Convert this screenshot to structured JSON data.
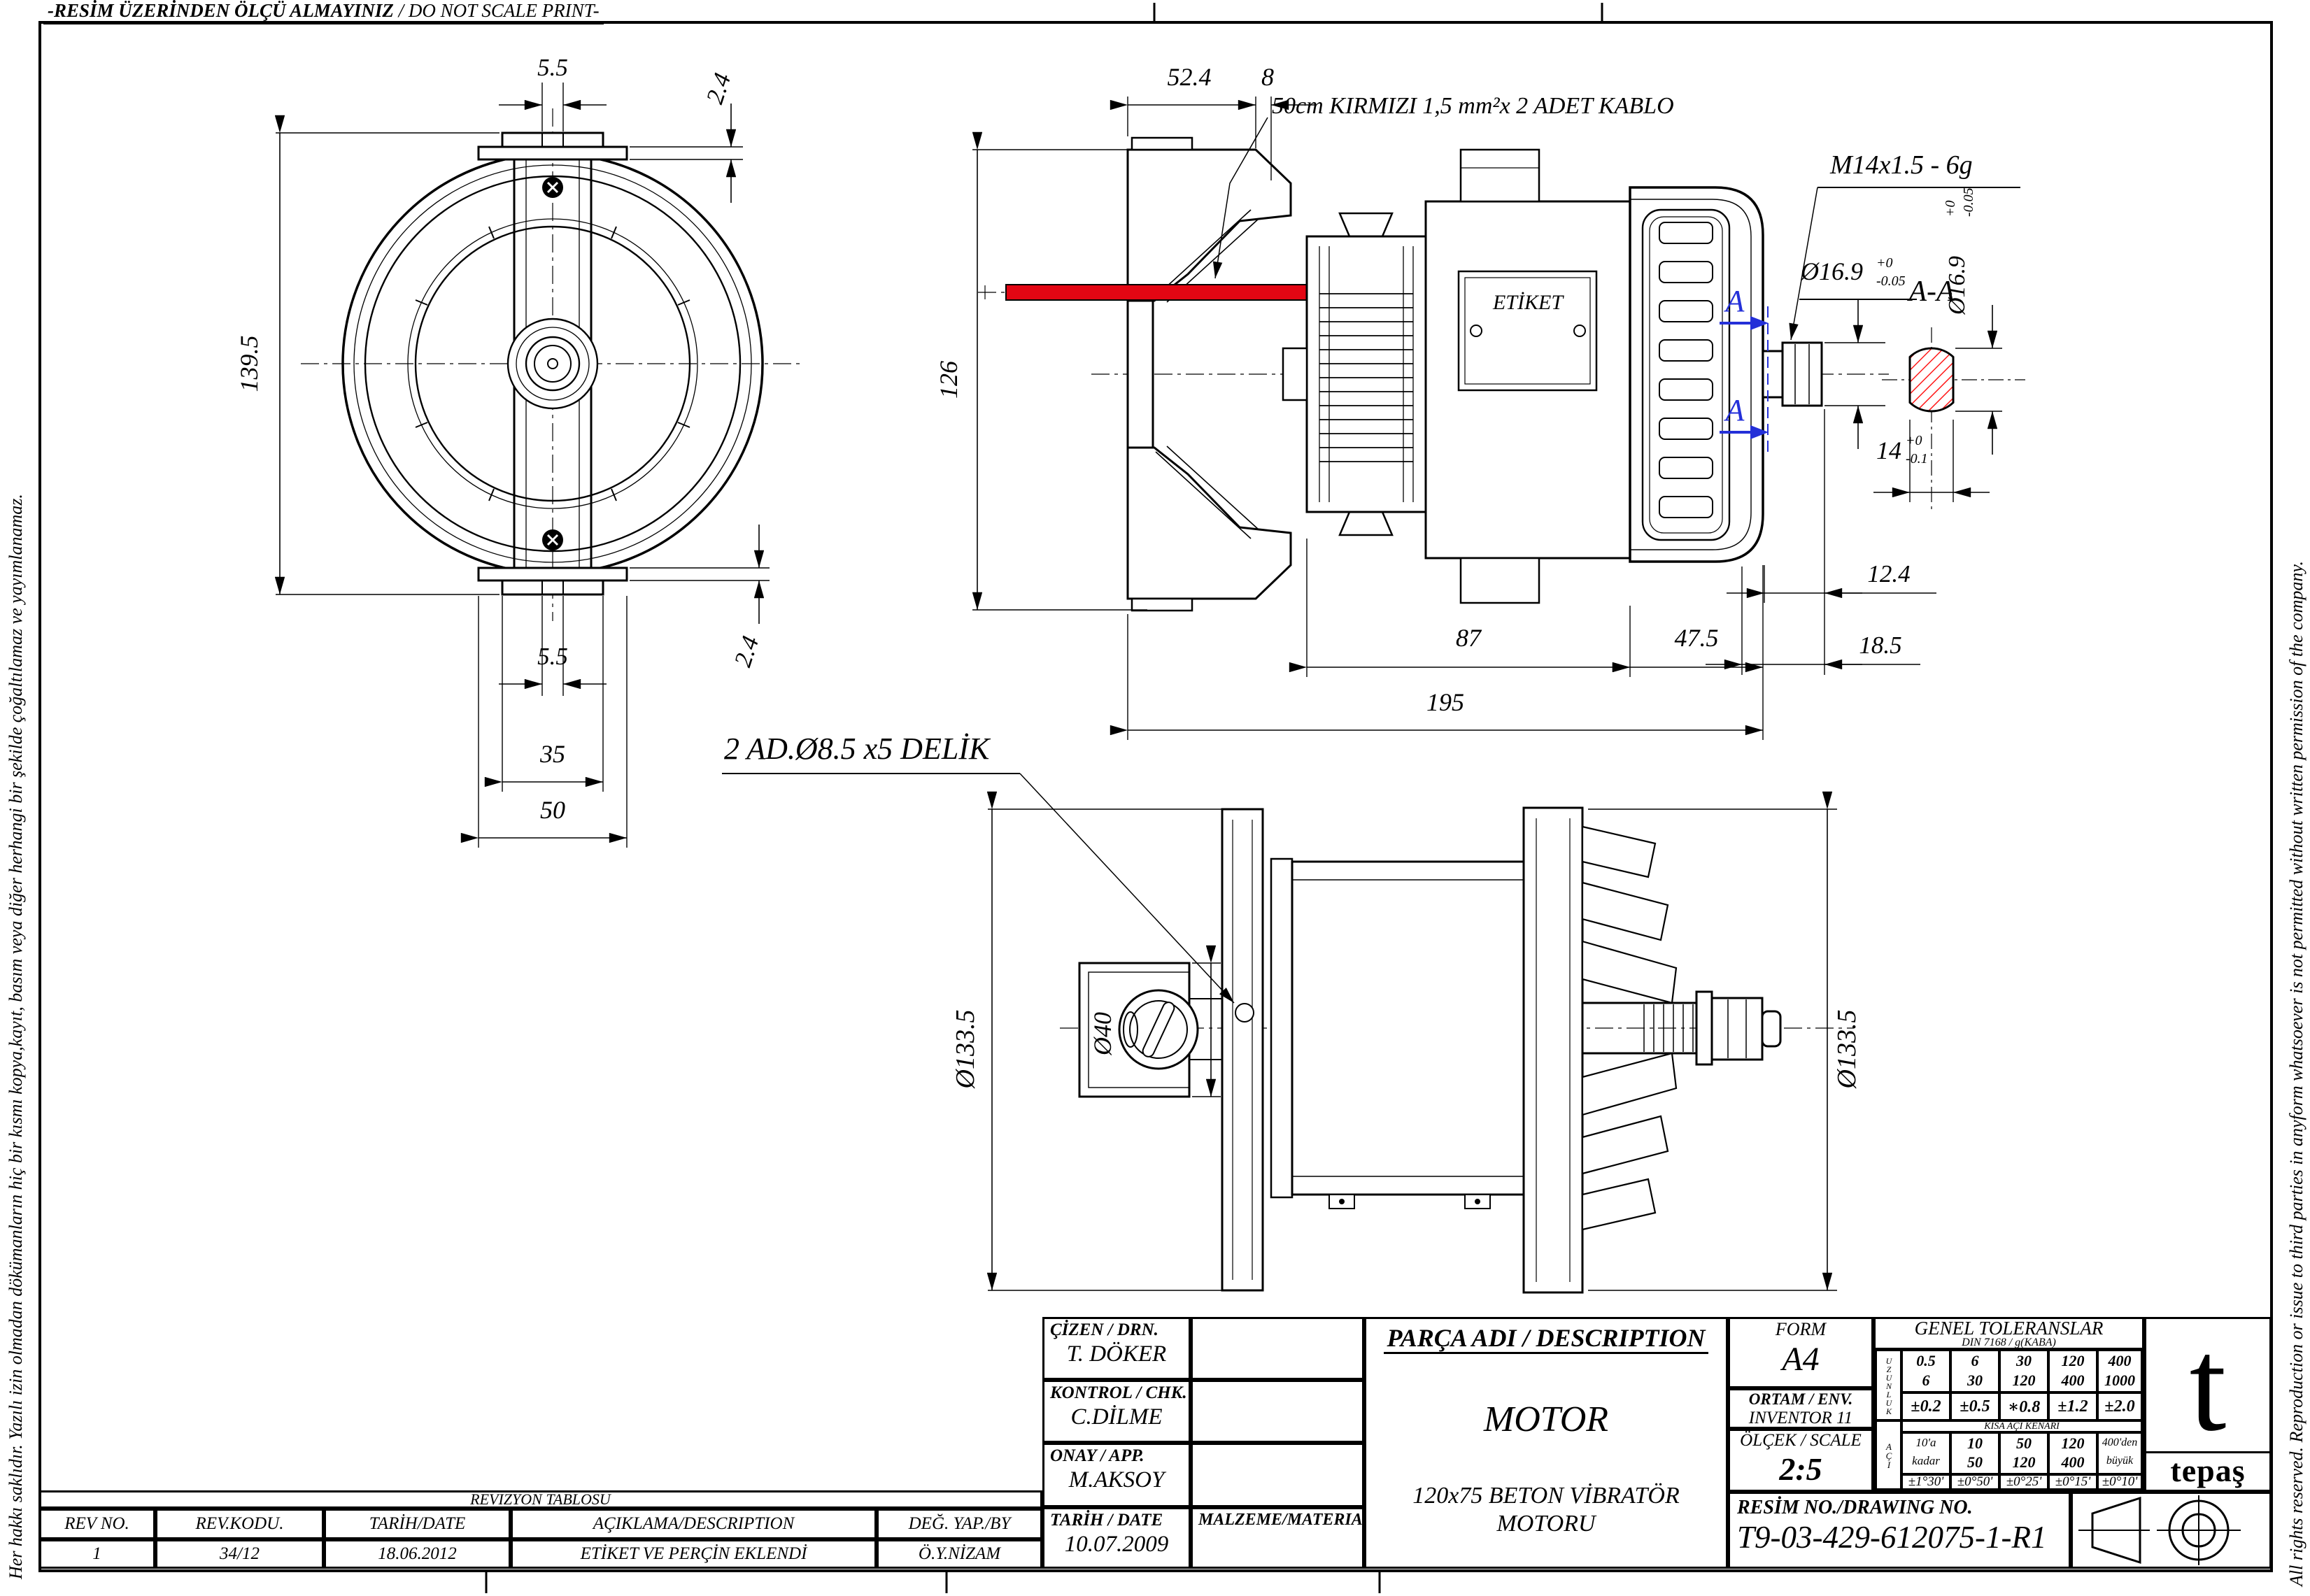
{
  "colors": {
    "line": "#000000",
    "cable": "#e30613",
    "hatch": "#ff1a1a",
    "section_blue": "#2430d8"
  },
  "sheet": {
    "scale_warning_tr": "-RESİM ÜZERİNDEN ÖLÇÜ ALMAYINIZ",
    "scale_warning_en": " / DO NOT SCALE PRINT-",
    "copyright_left": "Her hakkı saklıdır. Yazılı izin olmadan dökümanların hiç bir kısmı kopya,kayıt, basım veya diğer herhangi bir şekilde çoğaltılamaz ve yayımlanamaz.",
    "copyright_right": "All rights reserved. Reproduction or issue to third parties in anyform whatsoever is not permitted without written permission of the company."
  },
  "front_view": {
    "dim_slot_top": "5.5",
    "dim_lip_top": "2.4",
    "dim_height": "139.5",
    "dim_slot_bottom": "5.5",
    "dim_lip_bottom": "2.4",
    "dim_tab_width": "35",
    "dim_base_width": "50"
  },
  "side_view": {
    "dim_bracket": "52.4",
    "dim_bracket_lip": "8",
    "dim_height": "126",
    "dim_body": "87",
    "dim_bell": "47.5",
    "dim_total": "195",
    "dim_thread": "12.4",
    "dim_shaft": "18.5",
    "cable_note": "50cm KIRMIZI 1,5 mm²x 2 ADET KABLO",
    "thread_spec": "M14x1.5 - 6g",
    "shaft_dia": "Ø16.9",
    "shaft_dia_tol_up": "+0",
    "shaft_dia_tol_dn": "-0.05",
    "plate_label": "ETİKET",
    "section_letter": "A"
  },
  "section_aa": {
    "title": "A-A",
    "dia": "Ø16.9",
    "dia_tol_up": "+0",
    "dia_tol_dn": "-0.05",
    "flat": "14",
    "flat_tol_up": "+0",
    "flat_tol_dn": "-0.1"
  },
  "bottom_view": {
    "dia_left": "Ø133.5",
    "dia_boss": "Ø40",
    "dia_right": "Ø133.5",
    "holes_note": "2 AD.Ø8.5 x5 DELİK"
  },
  "title_block": {
    "drawn_label": "ÇİZEN / DRN.",
    "drawn_value": "T. DÖKER",
    "checked_label": "KONTROL / CHK.",
    "checked_value": "C.DİLME",
    "approved_label": "ONAY / APP.",
    "approved_value": "M.AKSOY",
    "date_label": "TARİH / DATE",
    "date_value": "10.07.2009",
    "material_label": "MALZEME/MATERIAL",
    "description_label": "PARÇA ADI / DESCRIPTION",
    "part_name": "MOTOR",
    "part_detail_1": "120x75 BETON VİBRATÖR",
    "part_detail_2": "MOTORU",
    "form_label": "FORM",
    "form_value": "A4",
    "env_label": "ORTAM / ENV.",
    "env_value": "INVENTOR 11",
    "scale_label": "ÖLÇEK / SCALE",
    "scale_value": "2:5",
    "drawing_no_label": "RESİM NO./DRAWING NO.",
    "drawing_no_value": "T9-03-429-612075-1-R1",
    "logo_text": "tepaş"
  },
  "tolerances": {
    "title": "GENEL TOLERANSLAR",
    "subtitle": "DIN 7168 / g(KABA)",
    "length_label": "UZUNLUK",
    "length_ranges": [
      [
        "0.5",
        "6"
      ],
      [
        "6",
        "30"
      ],
      [
        "30",
        "120"
      ],
      [
        "120",
        "400"
      ],
      [
        "400",
        "1000"
      ]
    ],
    "length_values": [
      "±0.2",
      "±0.5",
      "∗0.8",
      "±1.2",
      "±2.0"
    ],
    "short_edge_note": "KISA AÇI KENARI",
    "angle_label": "AÇI",
    "angle_ranges": [
      [
        "10'a",
        "kadar"
      ],
      [
        "10",
        "50"
      ],
      [
        "50",
        "120"
      ],
      [
        "120",
        "400"
      ],
      [
        "400'den",
        "büyük"
      ]
    ],
    "angle_values": [
      "±1°30'",
      "±0°50'",
      "±0°25'",
      "±0°15'",
      "±0°10'"
    ]
  },
  "revision_table": {
    "title": "REVIZYON TABLOSU",
    "headers": [
      "REV NO.",
      "REV.KODU.",
      "TARİH/DATE",
      "AÇIKLAMA/DESCRIPTION",
      "DEĞ. YAP./BY"
    ],
    "rows": [
      [
        "1",
        "34/12",
        "18.06.2012",
        "ETİKET VE PERÇİN EKLENDİ",
        "Ö.Y.NİZAM"
      ]
    ]
  }
}
